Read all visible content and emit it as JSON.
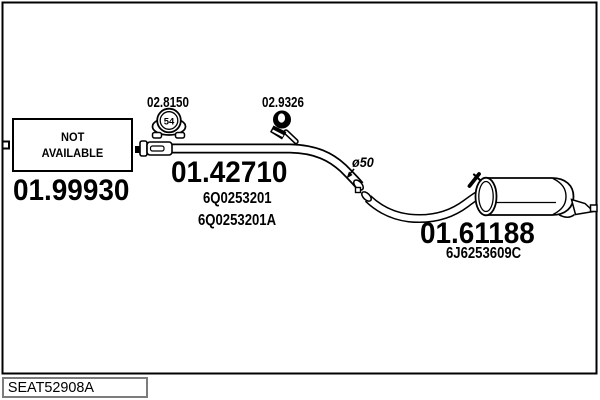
{
  "window": {
    "background": "#ffffff"
  },
  "diagram": {
    "line_color": "#000000",
    "footer_border_color": "#7c7c7c",
    "labels": {
      "clamp_front": "02.8150",
      "clamp_front_badge": "54",
      "clamp_rear": "02.9326",
      "not_available_line1": "NOT",
      "not_available_line2": "AVAILABLE",
      "part_front": "01.99930",
      "part_mid": "01.42710",
      "part_mid_oem1": "6Q0253201",
      "part_mid_oem2": "6Q0253201A",
      "pipe_diameter": "ø50",
      "part_rear": "01.61188",
      "part_rear_oem": "6J6253609C",
      "footer_code": "SEAT52908A"
    }
  }
}
